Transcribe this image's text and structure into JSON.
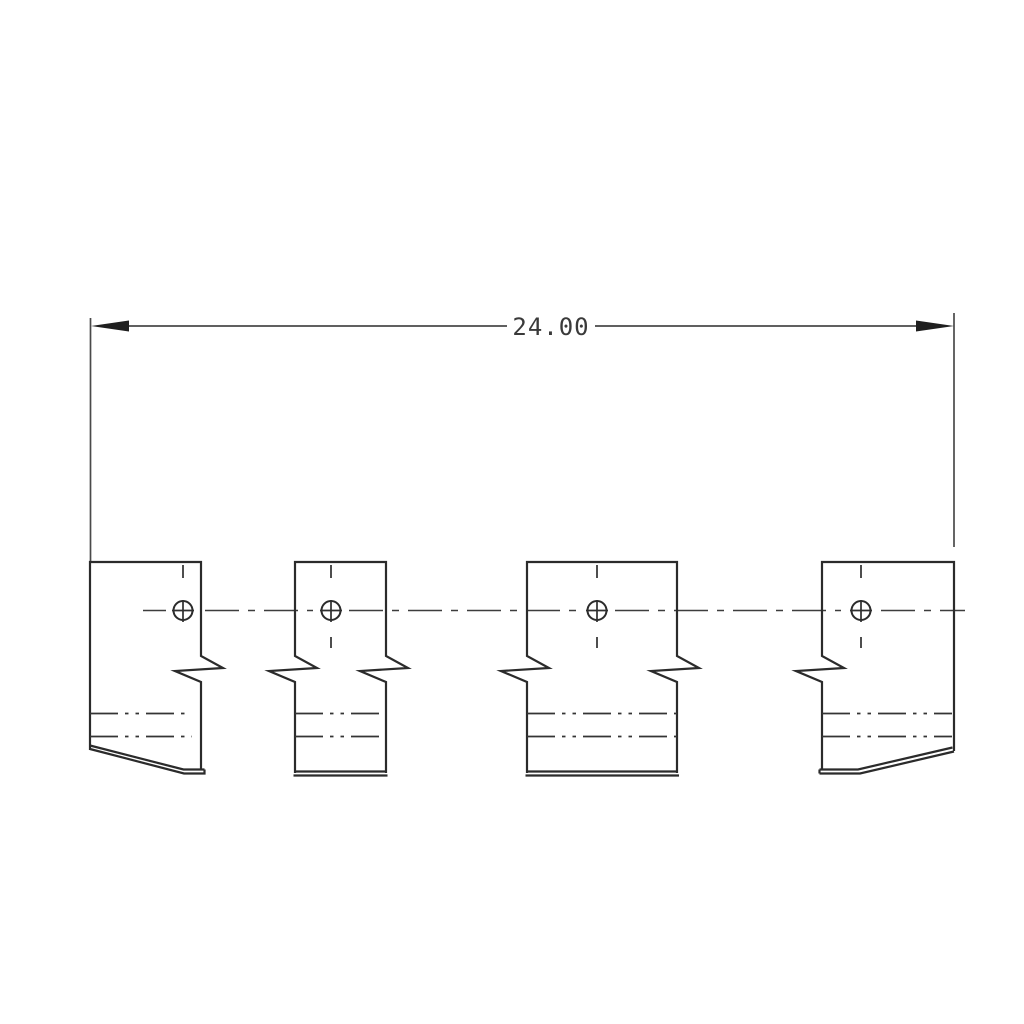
{
  "drawing": {
    "type": "technical-drawing",
    "view": "front-view-sheet-metal-clips",
    "parts_count": 4,
    "holes_count": 4
  },
  "dimension": {
    "value": "24.00"
  },
  "parts": [
    {
      "label": "left-end-clip",
      "hole": "round-hole",
      "bottom": "beveled-right"
    },
    {
      "label": "narrow-middle-clip",
      "hole": "round-hole",
      "bottom": "flat"
    },
    {
      "label": "wide-middle-clip",
      "hole": "round-hole",
      "bottom": "flat"
    },
    {
      "label": "right-end-clip",
      "hole": "round-hole",
      "bottom": "beveled-left"
    }
  ],
  "colors": {
    "background": "#ffffff",
    "object_line": "#2b2b2b",
    "center_line": "#3d3d3d",
    "dimension_line": "#4a4a4a",
    "dimension_text": "#3a3a3a"
  }
}
